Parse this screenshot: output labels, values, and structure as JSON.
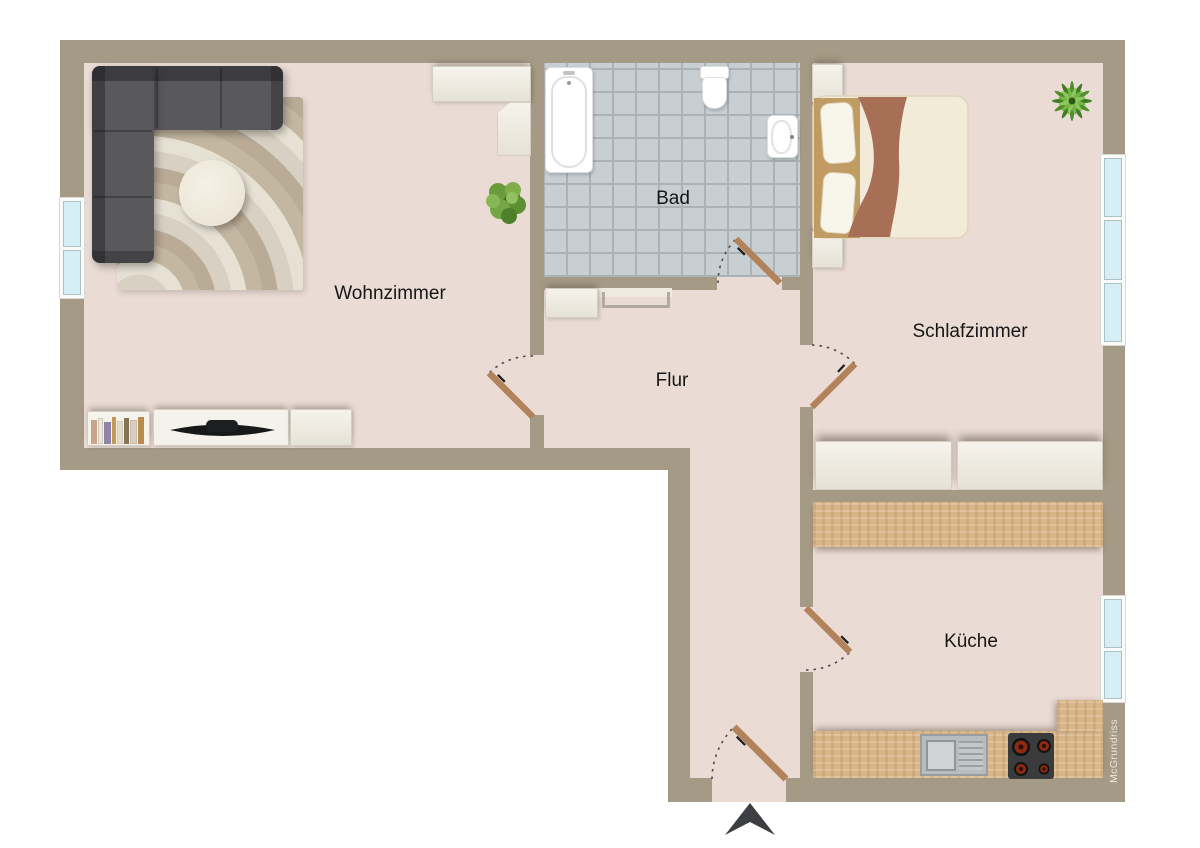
{
  "watermark": "McGrundriss",
  "rooms": [
    {
      "name": "wohnzimmer",
      "label": "Wohnzimmer"
    },
    {
      "name": "bad",
      "label": "Bad"
    },
    {
      "name": "schlafzimmer",
      "label": "Schlafzimmer"
    },
    {
      "name": "flur",
      "label": "Flur"
    },
    {
      "name": "kueche",
      "label": "Küche"
    }
  ],
  "palette": {
    "wall": "#a59a85",
    "floor": "#eadcd4",
    "bath_tile": "#c8cfd2",
    "tile_grout": "#aab2b6",
    "counter_wood": "#d9b58a",
    "door_wood": "#b2825a",
    "window_glass": "#d6eff6",
    "cabinet_light": "#f2efe6",
    "sofa_gray": "#57575a",
    "blanket_brown": "#a76f56",
    "plant_green": "#5f9e35",
    "arrow_dark": "#3c3e42"
  },
  "furniture": {
    "wohnzimmer": [
      "corner-sofa",
      "rug",
      "coffee-table",
      "corner-cabinet",
      "plant",
      "bookshelf",
      "tv-lowboard",
      "sideboard"
    ],
    "bad": [
      "bathtub",
      "toilet",
      "washbasin"
    ],
    "schlafzimmer": [
      "double-bed",
      "nightstand-top",
      "nightstand-bottom",
      "wardrobe-left",
      "wardrobe-right",
      "plant"
    ],
    "flur": [
      "cabinet",
      "wall-shelf"
    ],
    "kueche": [
      "counter-top",
      "counter-bottom",
      "sink",
      "stove"
    ]
  }
}
